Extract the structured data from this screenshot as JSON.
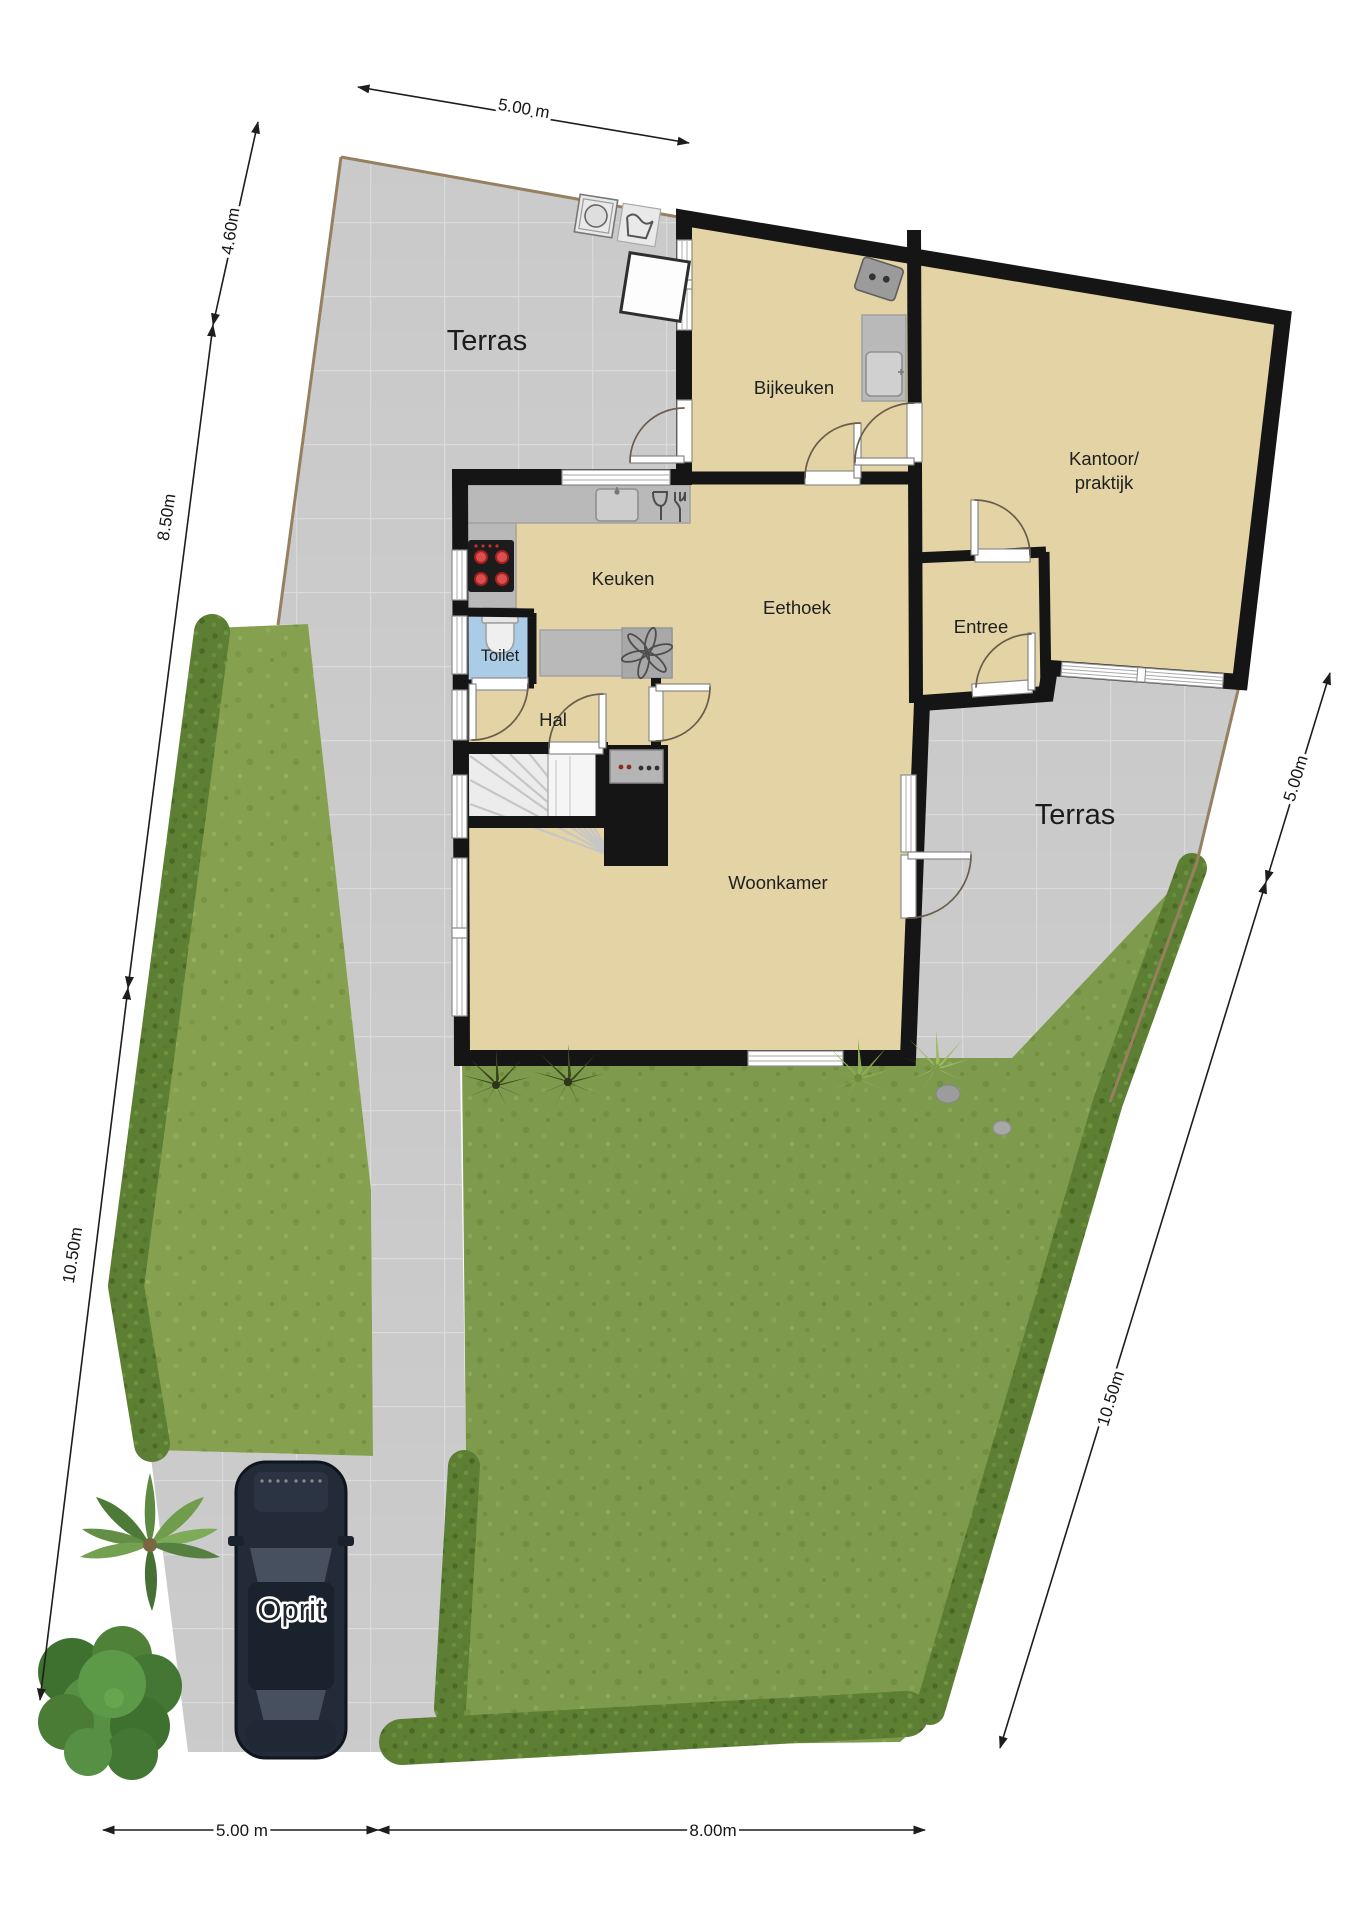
{
  "plan": {
    "title": "Begane grond plattegrond met tuin",
    "rooms": [
      {
        "label": "Bijkeuken"
      },
      {
        "line1": "Kantoor/",
        "line2": "praktijk"
      },
      {
        "label": "Keuken"
      },
      {
        "label": "Eethoek"
      },
      {
        "label": "Entree"
      },
      {
        "label": "Toilet"
      },
      {
        "label": "Hal"
      },
      {
        "label": "Woonkamer"
      }
    ],
    "areas": {
      "terrace_top": "Terras",
      "terrace_right": "Terras",
      "driveway": "Oprit"
    },
    "dimensions": {
      "top": "5.00 m",
      "left_upper": "4.60m",
      "left_middle": "8.50m",
      "left_lower": "10.50m",
      "right_upper": "5.00m",
      "right_lower": "10.50m",
      "bottom_left": "5.00 m",
      "bottom_right": "8.00m"
    },
    "icons": [
      "washing-machine-icon",
      "dryer-icon",
      "freezer-icon",
      "kitchen-appliance-icon",
      "utility-sink-icon",
      "kitchen-sink-icon",
      "cutlery-icon",
      "cooktop-icon",
      "extractor-fan-icon",
      "toilet-icon",
      "stove-icon",
      "staircase-icon",
      "car-icon",
      "palm-tree-icon",
      "bush-icon",
      "dark-shrub-icon",
      "fern-icon",
      "stone-icon"
    ],
    "colors": {
      "floor": "#e3d3a5",
      "terrace": "#cbcbcb",
      "wall": "#151515",
      "grass": "#7e9a4c",
      "grass_strip": "#85a150",
      "hedge": "#5d7f33",
      "toilet_floor": "#aacce7",
      "counter": "#b9b9b9",
      "burner": "#c03030",
      "boundary": "#97805f"
    }
  }
}
